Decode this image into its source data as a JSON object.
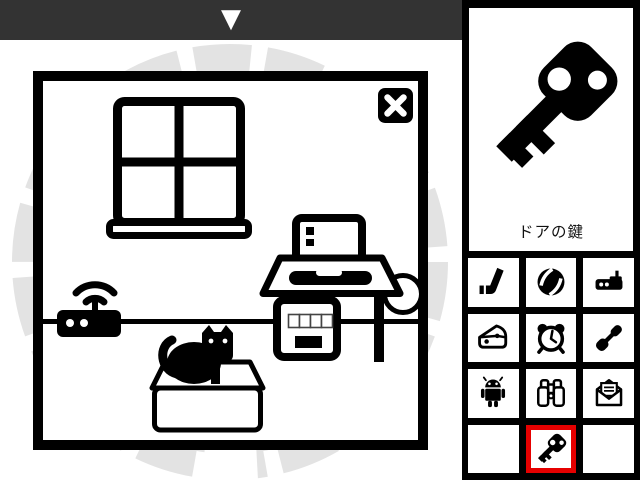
{
  "top_bar": {
    "arrow_glyph": "▼",
    "arrow_icon": "down-arrow-icon"
  },
  "scene": {
    "objects": [
      "window",
      "close-button",
      "wifi-router",
      "cat-in-box",
      "desk-with-laptop",
      "wall-line",
      "round-chair"
    ]
  },
  "item_display": {
    "label": "ドアの鍵",
    "icon": "key-icon"
  },
  "inventory": {
    "grid": {
      "rows": 4,
      "cols": 3
    },
    "slots": [
      {
        "slot": 1,
        "icon": "hockey-stick-icon",
        "selected": false
      },
      {
        "slot": 2,
        "icon": "ball-icon",
        "selected": false
      },
      {
        "slot": 3,
        "icon": "router-icon",
        "selected": false
      },
      {
        "slot": 4,
        "icon": "cheese-icon",
        "selected": false
      },
      {
        "slot": 5,
        "icon": "alarm-clock-icon",
        "selected": false
      },
      {
        "slot": 6,
        "icon": "screwdriver-icon",
        "selected": false
      },
      {
        "slot": 7,
        "icon": "android-icon",
        "selected": false
      },
      {
        "slot": 8,
        "icon": "binoculars-icon",
        "selected": false
      },
      {
        "slot": 9,
        "icon": "envelope-icon",
        "selected": false
      },
      {
        "slot": 10,
        "icon": "",
        "selected": false
      },
      {
        "slot": 11,
        "icon": "key-icon",
        "selected": true
      },
      {
        "slot": 12,
        "icon": "",
        "selected": false
      }
    ]
  },
  "colors": {
    "top_bar_bg": "#333333",
    "panel_bg": "#000000",
    "selected_border": "#e60000",
    "background_decoration": "#e3e3e3",
    "ink": "#000000",
    "surface": "#ffffff"
  }
}
